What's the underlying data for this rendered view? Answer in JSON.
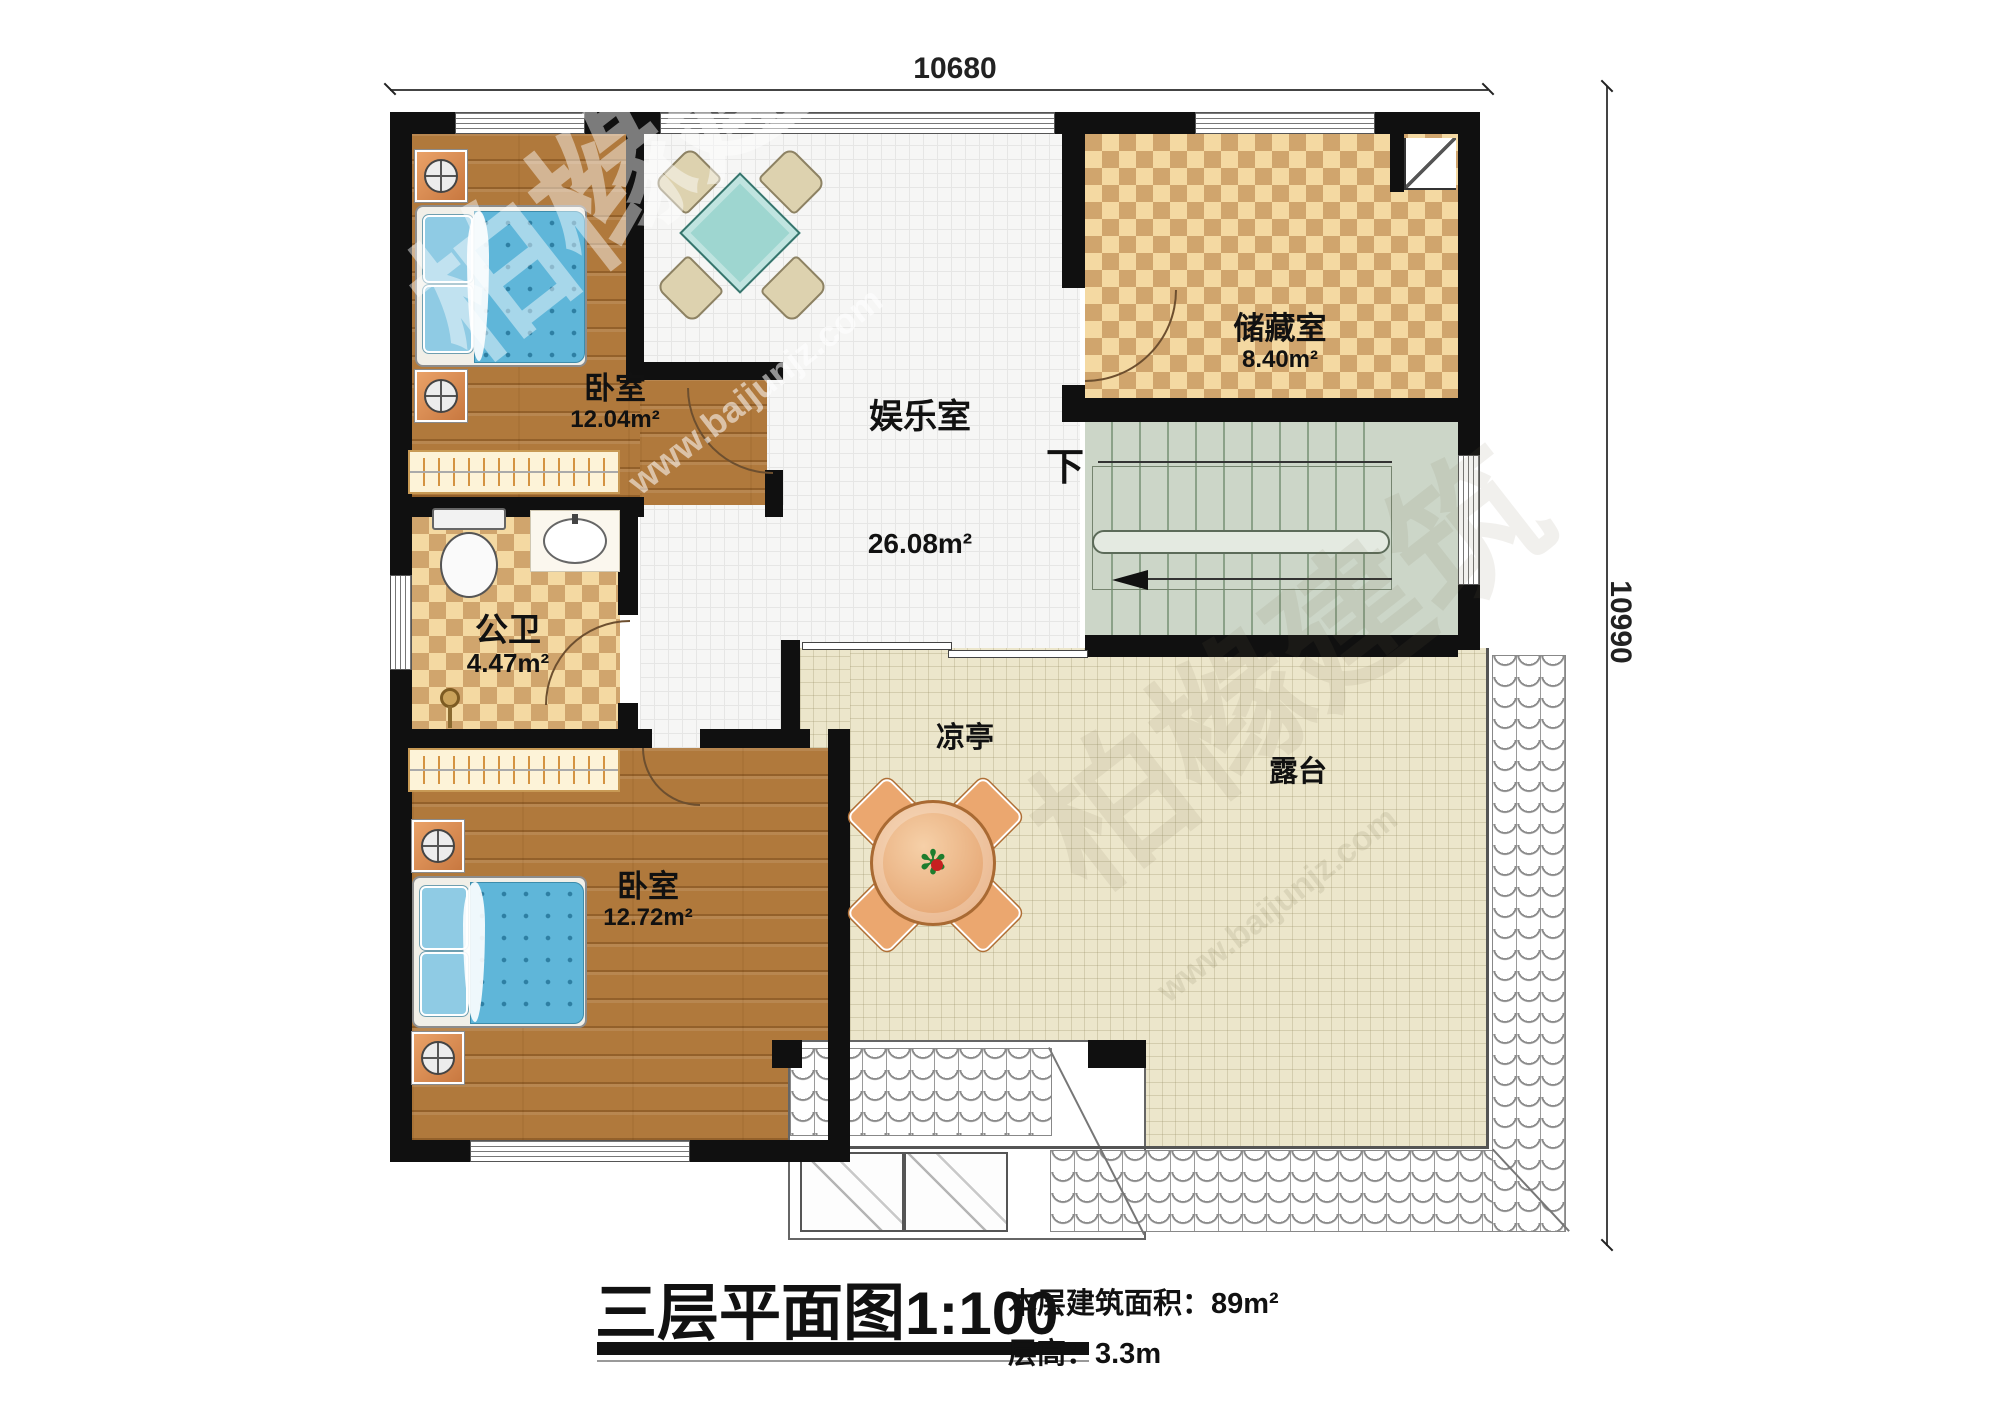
{
  "dimensions": {
    "top": "10680",
    "right": "10990"
  },
  "rooms": {
    "bedroom1": {
      "name": "卧室",
      "area": "12.04m²"
    },
    "entertainment": {
      "name": "娱乐室",
      "area": "26.08m²"
    },
    "storage": {
      "name": "储藏室",
      "area": "8.40m²"
    },
    "bathroom": {
      "name": "公卫",
      "area": "4.47m²"
    },
    "bedroom2": {
      "name": "卧室",
      "area": "12.72m²"
    },
    "pavilion": {
      "name": "凉亭"
    },
    "terrace": {
      "name": "露台"
    },
    "stairs": {
      "down_label": "下"
    }
  },
  "title": {
    "main": "三层平面图",
    "scale": "1:100",
    "floor_area": "本层建筑面积：89m²",
    "floor_height": "层高：3.3m"
  },
  "watermark": {
    "brand": "柏橼建筑",
    "site": "www.baijunjz.com"
  },
  "colors": {
    "wall": "#101010",
    "wood_floor": "#b0793c",
    "checker_light": "#f4d9a2",
    "checker_dark": "#d0a56d",
    "stair": "#ccd6c8",
    "terrace": "#ece6cb",
    "bed_blue": "#5fb6d9",
    "table_teal": "#9ed6d0",
    "pavilion_orange": "#e8a772"
  }
}
